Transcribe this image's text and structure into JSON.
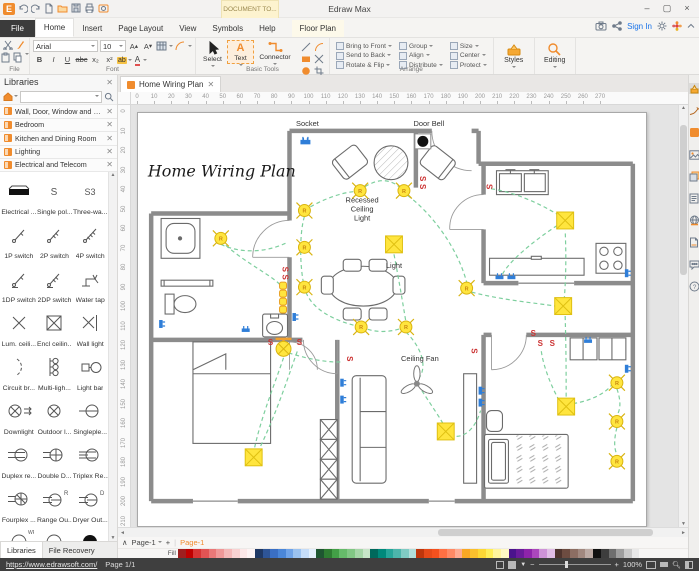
{
  "window": {
    "title": "Edraw Max",
    "document_tab": "DOCUMENT TO..."
  },
  "menu": {
    "tabs": [
      "File",
      "Home",
      "Insert",
      "Page Layout",
      "View",
      "Symbols",
      "Help"
    ],
    "active_tab": "Home",
    "context_tab": "Floor Plan",
    "sign_in": "Sign In"
  },
  "quick_access": {
    "icons": [
      "undo",
      "redo",
      "new-document",
      "open-folder",
      "save",
      "print",
      "snapshot"
    ]
  },
  "ribbon": {
    "font_name": "Arial",
    "font_size": "10",
    "format_buttons": [
      "B",
      "I",
      "U",
      "abc",
      "x₂",
      "x²"
    ],
    "tools": [
      {
        "label": "Select",
        "icon": "cursor"
      },
      {
        "label": "Text",
        "icon": "text-a"
      },
      {
        "label": "Connector",
        "icon": "connector"
      }
    ],
    "mini_tools": [
      "line",
      "arc",
      "rect",
      "freeform",
      "ellipse",
      "crop"
    ],
    "arrange_items": [
      [
        "Bring to Front",
        "Send to Back",
        "Rotate & Flip"
      ],
      [
        "Group",
        "Align",
        "Distribute"
      ],
      [
        "Size",
        "Center",
        "Protect"
      ]
    ],
    "styles_label": "Styles",
    "editing_label": "Editing",
    "group_labels": {
      "file": "File",
      "font": "Font",
      "basic_tools": "Basic Tools",
      "arrange": "Arrange"
    }
  },
  "libraries_panel": {
    "title": "Libraries",
    "items": [
      "Wall, Door, Window and Structure",
      "Bedroom",
      "Kitchen and Dining Room",
      "Lighting",
      "Electrical and Telecom"
    ],
    "symbols": [
      {
        "icon": "electrical-outlet-strip",
        "label": "Electrical ..."
      },
      {
        "icon": "single-pole-switch",
        "label": "Single pol..."
      },
      {
        "icon": "three-way-switch",
        "label": "Three-wa..."
      },
      {
        "icon": "switch-1p",
        "label": "1P switch"
      },
      {
        "icon": "switch-2p",
        "label": "2P switch"
      },
      {
        "icon": "switch-4p",
        "label": "4P switch"
      },
      {
        "icon": "switch-1dp",
        "label": "1DP switch"
      },
      {
        "icon": "switch-2dp",
        "label": "2DP switch"
      },
      {
        "icon": "water-tap",
        "label": "Water tap"
      },
      {
        "icon": "luminous-ceiling",
        "label": "Lum. ceili..."
      },
      {
        "icon": "enclosed-ceiling",
        "label": "Encl ceilin..."
      },
      {
        "icon": "wall-light",
        "label": "Wall light"
      },
      {
        "icon": "circuit-breaker",
        "label": "Circuit br..."
      },
      {
        "icon": "multi-light",
        "label": "Multi-ligh..."
      },
      {
        "icon": "light-bar",
        "label": "Light bar"
      },
      {
        "icon": "downlight",
        "label": "Downlight"
      },
      {
        "icon": "outdoor-light",
        "label": "Outdoor l..."
      },
      {
        "icon": "singleplex",
        "label": "Singleple..."
      },
      {
        "icon": "duplex-receptacle",
        "label": "Duplex re..."
      },
      {
        "icon": "double-duplex",
        "label": "Double D..."
      },
      {
        "icon": "triplex-receptacle",
        "label": "Triplex Re..."
      },
      {
        "icon": "fourplex",
        "label": "Fourplex ..."
      },
      {
        "icon": "range-outlet",
        "label": "Range Ou..."
      },
      {
        "icon": "dryer-outlet",
        "label": "Dryer Out..."
      }
    ],
    "partial_row_icons": [
      "wp-arc",
      "plain-arc",
      "dark-arc"
    ],
    "bottom_tabs": [
      "Libraries",
      "File Recovery"
    ]
  },
  "doc_tab": {
    "label": "Home Wiring Plan"
  },
  "rulers": {
    "h_max": 270,
    "v_max": 210,
    "step": 10
  },
  "canvas": {
    "labels": {
      "title": "Home Wiring Plan",
      "socket": "Socket",
      "door_bell": "Door Bell",
      "recessed": [
        "Recessed",
        "Ceiling",
        "Light"
      ],
      "light": "Light",
      "ceiling_fan": "Ceiling Fan"
    },
    "switch_mark": "S",
    "recessed_mark": "R",
    "accent_colors": {
      "light_yellow": "#ffe53e",
      "wire_green": "#7ecf9e",
      "switch_red": "#cc3333",
      "socket_blue": "#2f7ed8"
    },
    "recessed_lights": [
      [
        223,
        78
      ],
      [
        267,
        78
      ],
      [
        167,
        98
      ],
      [
        167,
        135
      ],
      [
        167,
        175
      ],
      [
        224,
        215
      ],
      [
        269,
        215
      ],
      [
        330,
        176
      ],
      [
        481,
        271
      ],
      [
        481,
        310
      ],
      [
        481,
        350
      ],
      [
        83,
        126
      ]
    ],
    "square_lights": [
      [
        257,
        132
      ],
      [
        429,
        108
      ],
      [
        427,
        194
      ],
      [
        430,
        295
      ],
      [
        116,
        346
      ],
      [
        309,
        320
      ]
    ],
    "switches": [
      [
        145,
        157,
        90
      ],
      [
        145,
        165,
        90
      ],
      [
        283,
        66,
        90
      ],
      [
        283,
        74,
        90
      ],
      [
        350,
        74,
        90
      ],
      [
        133,
        233,
        0
      ],
      [
        162,
        233,
        0
      ],
      [
        210,
        247,
        90
      ],
      [
        335,
        239,
        90
      ],
      [
        397,
        224,
        0
      ],
      [
        404,
        234,
        0
      ],
      [
        416,
        234,
        0
      ]
    ],
    "sockets": [
      [
        168,
        29,
        0
      ],
      [
        157,
        205,
        90
      ],
      [
        23,
        212,
        90
      ],
      [
        108,
        218,
        0
      ],
      [
        205,
        271,
        90
      ],
      [
        205,
        288,
        90
      ],
      [
        344,
        279,
        90
      ],
      [
        344,
        291,
        90
      ],
      [
        363,
        165,
        0
      ],
      [
        375,
        165,
        0
      ],
      [
        491,
        161,
        90
      ],
      [
        491,
        257,
        90
      ],
      [
        452,
        229,
        0
      ]
    ],
    "bar_lights": [
      [
        142,
        170
      ],
      [
        142,
        178
      ],
      [
        142,
        186
      ],
      [
        142,
        194
      ]
    ],
    "lamp": [
      146,
      237
    ],
    "fan": [
      280,
      272
    ],
    "wires": [
      "M83,132 C100,140 125,142 150,130",
      "M88,133 C110,152 132,162 142,172",
      "M167,104 C162,120 162,155 167,175 C172,198 200,210 224,215",
      "M224,215 C240,222 255,220 269,215",
      "M167,98 C182,88 203,80 217,79",
      "M228,74 C241,66 252,66 262,74",
      "M271,83 C296,102 321,136 330,170",
      "M257,142 C262,168 266,192 269,210",
      "M269,220 C285,236 290,254 283,265",
      "M285,279 C296,296 303,306 308,315",
      "M335,180 C366,188 400,191 419,194",
      "M428,188 C430,164 430,140 429,118",
      "M423,103 C399,88 372,78 353,76",
      "M421,113 C395,130 372,150 366,162",
      "M429,204 C430,240 430,264 430,285",
      "M437,292 C456,289 470,281 476,273",
      "M481,277 C485,289 485,297 481,304",
      "M481,316 C478,328 478,337 481,343",
      "M423,289 C411,267 406,248 405,239",
      "M146,246 C138,270 124,304 117,336",
      "M120,341 C140,300 153,258 160,239",
      "M151,241 C176,249 196,251 205,250",
      "M313,324 C330,329 340,313 344,299"
    ]
  },
  "page_bar": {
    "page_selector": "Page-1",
    "add_label": "+",
    "active_page": "Page-1"
  },
  "palette": {
    "fill_label": "Fill",
    "colors": [
      "#9e1f1f",
      "#c00000",
      "#d83434",
      "#e25454",
      "#ea7878",
      "#f09898",
      "#f5b8b8",
      "#f9d2d2",
      "#fce8e8",
      "#fdf4f4",
      "#1f3864",
      "#2e5597",
      "#3a6fc4",
      "#4a86d8",
      "#6fa3e8",
      "#9bc2f0",
      "#c5dcf8",
      "#e3effc",
      "#1e5631",
      "#2e7d32",
      "#43a047",
      "#66bb6a",
      "#81c784",
      "#a5d6a7",
      "#c8e6c9",
      "#00695c",
      "#00897b",
      "#26a69a",
      "#4db6ac",
      "#80cbc4",
      "#b2dfdb",
      "#bf360c",
      "#e64a19",
      "#f4511e",
      "#ff7043",
      "#ff8a65",
      "#ffab91",
      "#f9a825",
      "#fbc02d",
      "#fdd835",
      "#ffee58",
      "#fff59d",
      "#fff9c4",
      "#4a148c",
      "#6a1b9a",
      "#8e24aa",
      "#ab47bc",
      "#ce93d8",
      "#e1bee7",
      "#4e342e",
      "#6d4c41",
      "#8d6e63",
      "#a1887f",
      "#bcaaa4",
      "#111111",
      "#3d3d3d",
      "#6e6e6e",
      "#9e9e9e",
      "#c9c9c9",
      "#e8e8e8"
    ]
  },
  "right_panel": {
    "icons": [
      "format-painter",
      "signature-pen",
      "fill-color",
      "insert-image",
      "layers",
      "note-document",
      "hyperlink-globe",
      "new-page",
      "comment",
      "help"
    ]
  },
  "status_bar": {
    "url": "https://www.edrawsoft.com/",
    "page_info": "Page 1/1",
    "zoom_level": "100%"
  }
}
